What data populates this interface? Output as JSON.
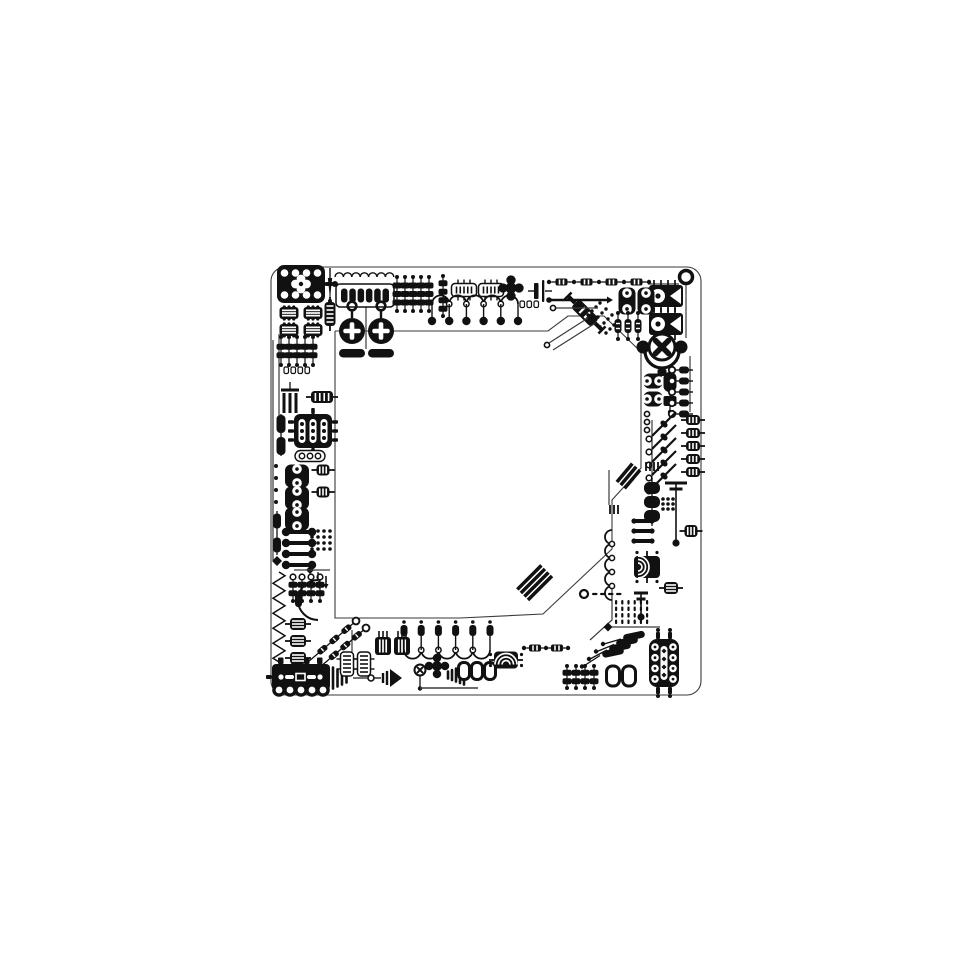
{
  "canvas": {
    "width": 960,
    "height": 960,
    "background": "#ffffff",
    "ink": "#111111",
    "trace_color": "#3a3a3a",
    "white": "#ffffff"
  },
  "traces": [
    {
      "t": "orect",
      "n": "outer-outline",
      "x": 271,
      "y": 267,
      "w": 430,
      "h": 428,
      "r": 14
    },
    {
      "t": "trace",
      "n": "inner-outline",
      "pts": [
        [
          335,
          331
        ],
        [
          548,
          331
        ],
        [
          568,
          316
        ],
        [
          604,
          316
        ],
        [
          641,
          352
        ],
        [
          641,
          468
        ],
        [
          612,
          500
        ],
        [
          612,
          549
        ],
        [
          543,
          614
        ],
        [
          460,
          618
        ],
        [
          335,
          618
        ],
        [
          335,
          331
        ]
      ],
      "sw": 1.1
    },
    {
      "t": "trace",
      "n": "trace-1",
      "pts": [
        [
          330,
          268
        ],
        [
          330,
          300
        ]
      ],
      "sw": 1.2
    },
    {
      "t": "trace",
      "n": "trace-2",
      "pts": [
        [
          366,
          284
        ],
        [
          366,
          349
        ]
      ],
      "sw": 1.2
    },
    {
      "t": "trace",
      "n": "trace-3",
      "pts": [
        [
          648,
          284
        ],
        [
          679,
          284
        ]
      ],
      "sw": 1.2
    },
    {
      "t": "trace",
      "n": "trace-4",
      "pts": [
        [
          686,
          284
        ],
        [
          686,
          338
        ]
      ],
      "sw": 1.2
    },
    {
      "t": "trace",
      "n": "trace-5",
      "pts": [
        [
          690,
          356
        ],
        [
          690,
          412
        ]
      ],
      "sw": 1.2
    },
    {
      "t": "trace",
      "n": "trace-6",
      "pts": [
        [
          652,
          420
        ],
        [
          652,
          488
        ]
      ],
      "sw": 1.2
    },
    {
      "t": "trace",
      "n": "trace-7",
      "pts": [
        [
          609,
          470
        ],
        [
          609,
          505
        ]
      ],
      "sw": 1.2
    },
    {
      "t": "trace",
      "n": "trace-8",
      "pts": [
        [
          279,
          334
        ],
        [
          279,
          420
        ]
      ],
      "sw": 1.2
    },
    {
      "t": "trace",
      "n": "trace-9",
      "pts": [
        [
          273,
          340
        ],
        [
          273,
          560
        ]
      ],
      "sw": 1.2
    },
    {
      "t": "trace",
      "n": "trace-10",
      "pts": [
        [
          612,
          584
        ],
        [
          612,
          620
        ],
        [
          590,
          640
        ]
      ],
      "sw": 1.2
    },
    {
      "t": "trace",
      "n": "trace-11",
      "pts": [
        [
          352,
          630
        ],
        [
          352,
          652
        ]
      ],
      "sw": 1.2
    }
  ],
  "components": [
    {
      "t": "icPads",
      "n": "ic-chip-top-left",
      "cx": 301,
      "cy": 284,
      "w": 48,
      "h": 38
    },
    {
      "t": "dipStriped",
      "n": "striped-cap-grid",
      "at": [
        [
          289,
          313
        ],
        [
          313,
          313
        ],
        [
          289,
          330
        ],
        [
          313,
          330
        ]
      ],
      "w": 19,
      "h": 12,
      "o": "h"
    },
    {
      "t": "needle",
      "n": "pin-needle",
      "x": 330,
      "y": 268,
      "len": 30
    },
    {
      "t": "ribbedCap",
      "n": "coil-inductor",
      "cx": 330,
      "cy": 314,
      "w": 11,
      "h": 24,
      "o": "h",
      "ribs": 5
    },
    {
      "t": "scallop",
      "n": "scallop-trace",
      "x": 335,
      "y": 277,
      "num": 7,
      "r": 4.2
    },
    {
      "t": "capRow",
      "n": "pad-array-top",
      "x": 336,
      "y": 284,
      "w": 58,
      "h": 23,
      "slots": 6
    },
    {
      "t": "keyhole",
      "n": "keyhole-pad-left",
      "cx": 352,
      "ty": 302
    },
    {
      "t": "keyhole",
      "n": "keyhole-pad-right",
      "cx": 381,
      "ty": 302
    },
    {
      "t": "beadCol",
      "n": "bead-columns-top",
      "at": [
        [
          397,
          294
        ],
        [
          405,
          294
        ],
        [
          413,
          294
        ],
        [
          421,
          294
        ],
        [
          429,
          294
        ]
      ],
      "beads": 3,
      "h": 34
    },
    {
      "t": "beadCol",
      "n": "bead-strip",
      "cx": 443,
      "cy": 296,
      "beads": 4,
      "h": 40
    },
    {
      "t": "dipOutline",
      "n": "striped-ic-a",
      "cx": 464,
      "cy": 290,
      "w": 25,
      "h": 13,
      "o": "h"
    },
    {
      "t": "dipOutline",
      "n": "striped-ic-b",
      "cx": 491,
      "cy": 290,
      "w": 25,
      "h": 13,
      "o": "h"
    },
    {
      "t": "flower5",
      "n": "dot-cluster-top",
      "cx": 511,
      "cy": 288,
      "r": 5.5,
      "d": 8
    },
    {
      "t": "waveTrace",
      "n": "wave-trace-top",
      "x": 432,
      "y": 304,
      "num": 5,
      "r": 8.6,
      "dir": "up",
      "pins": "down",
      "pad": "circle"
    },
    {
      "t": "microPads",
      "n": "micro-pads-top",
      "x": 520,
      "y": 301,
      "num": 3
    },
    {
      "t": "capBars",
      "n": "capacitor-symbol",
      "cx": 541,
      "cy": 291
    },
    {
      "t": "thickLink",
      "n": "bus-link",
      "x1": 549,
      "y1": 300,
      "x2": 607,
      "y2": 300
    },
    {
      "t": "resistorChainH",
      "n": "resistor-chain-top",
      "x": 549,
      "y": 282,
      "num": 4,
      "pitch": 25
    },
    {
      "t": "ringPad",
      "n": "corner-via",
      "cx": 686,
      "cy": 277,
      "r": 6.5,
      "sw": 3.5
    },
    {
      "t": "speakerIC",
      "n": "opto-ic-a",
      "cx": 666,
      "cy": 296,
      "w": 34,
      "h": 22
    },
    {
      "t": "speakerIC",
      "n": "opto-ic-b",
      "cx": 666,
      "cy": 324,
      "w": 34,
      "h": 22
    },
    {
      "t": "diagResistor",
      "n": "diagonal-resistor",
      "cx": 585,
      "cy": 313,
      "a": 45
    },
    {
      "t": "diagDots",
      "n": "diagonal-dots",
      "x": 600,
      "y": 303,
      "rows": 4,
      "cols": 4
    },
    {
      "t": "ring8",
      "n": "double-ring-a",
      "cx": 627,
      "cy": 301,
      "w": 17,
      "h": 27,
      "o": "v"
    },
    {
      "t": "ring8",
      "n": "double-ring-b",
      "cx": 646,
      "cy": 301,
      "w": 17,
      "h": 27,
      "o": "v"
    },
    {
      "t": "beadCol",
      "n": "resistor-triple",
      "at": [
        [
          618,
          326
        ],
        [
          628,
          326
        ],
        [
          638,
          326
        ]
      ],
      "beads": 1,
      "h": 26
    },
    {
      "t": "xFan",
      "n": "fan-component",
      "cx": 662,
      "cy": 347,
      "r": 13
    },
    {
      "t": "ringPad",
      "n": "via-a",
      "cx": 547,
      "cy": 345,
      "r": 2.6,
      "sw": 1.6
    },
    {
      "t": "trace",
      "n": "diag-trace-a",
      "pts": [
        [
          549,
          343
        ],
        [
          588,
          318
        ]
      ],
      "sw": 1.2
    },
    {
      "t": "trace",
      "n": "diag-trace-b",
      "pts": [
        [
          553,
          350
        ],
        [
          594,
          324
        ]
      ],
      "sw": 1.2
    },
    {
      "t": "trace",
      "n": "h-trace-a",
      "pts": [
        [
          556,
          308
        ],
        [
          598,
          308
        ]
      ],
      "sw": 1.2
    },
    {
      "t": "ringPad",
      "n": "via-b",
      "cx": 553,
      "cy": 308,
      "r": 2.6,
      "sw": 1.6
    },
    {
      "t": "ring8",
      "n": "double-ring-right",
      "at": [
        [
          653,
          381
        ],
        [
          653,
          399
        ]
      ],
      "w": 19,
      "h": 15,
      "o": "h"
    },
    {
      "t": "capSq",
      "n": "cap-and-square",
      "cx": 670,
      "cy": 382
    },
    {
      "t": "diodeCol",
      "n": "diode-column",
      "x": 672,
      "y": 370,
      "num": 5,
      "st": 11
    },
    {
      "t": "ribbedCap",
      "n": "ribbed-caps-right",
      "at": [
        [
          693,
          420
        ],
        [
          693,
          433
        ],
        [
          693,
          446
        ],
        [
          693,
          459
        ],
        [
          693,
          472
        ]
      ],
      "w": 14,
      "h": 10,
      "o": "v",
      "ribs": 3
    },
    {
      "t": "dotCol",
      "n": "via-column",
      "cx": 647,
      "ys": [
        414,
        422,
        430
      ],
      "r": 2.6,
      "ring": true
    },
    {
      "t": "diagLadder",
      "n": "diagonal-ladder",
      "x": 652,
      "y": 436,
      "num": 5,
      "st": 13
    },
    {
      "t": "pinComb",
      "n": "pin-comb-right",
      "x": 646,
      "y": 462,
      "num": 4
    },
    {
      "t": "diagStripes",
      "n": "cable-stripes-a",
      "x": 640,
      "y": 470,
      "num": 3,
      "len": 24,
      "a": 130
    },
    {
      "t": "capsuleChainV",
      "n": "capsule-chain-right",
      "cx": 652,
      "ys": [
        488,
        502,
        516
      ],
      "w": 16,
      "h": 12
    },
    {
      "t": "antennaT",
      "n": "antenna-cap",
      "x": 676,
      "y1": 482,
      "y2": 540,
      "w1": 22,
      "w2": 13
    },
    {
      "t": "dotGrid",
      "n": "dot-grid-right",
      "cx": 668,
      "cy": 504,
      "rows": 3,
      "cols": 3,
      "p": 5
    },
    {
      "t": "ribbedCap",
      "n": "slot-component",
      "cx": 691,
      "cy": 531,
      "w": 13,
      "h": 12,
      "o": "v",
      "ribs": 3
    },
    {
      "t": "dumbbellRow",
      "n": "pin-pair-rows",
      "at": [
        [
          643,
          521
        ],
        [
          643,
          531
        ],
        [
          643,
          541
        ]
      ],
      "w": 18,
      "r": 2.6
    },
    {
      "t": "arcRadiator",
      "n": "arc-component-right",
      "cx": 647,
      "cy": 567,
      "w": 22,
      "h": 26,
      "rot": 90
    },
    {
      "t": "ringWaveV",
      "n": "ring-wave-right",
      "x": 612,
      "y": 530,
      "num": 5,
      "r": 7
    },
    {
      "t": "pinComb",
      "n": "pin-comb-mid",
      "x": 610,
      "y": 505,
      "num": 3
    },
    {
      "t": "ribbedCap",
      "n": "ribbed-small-right",
      "cx": 671,
      "cy": 588,
      "w": 14,
      "h": 12,
      "o": "h",
      "ribs": 3
    },
    {
      "t": "antennaT",
      "n": "cap-t-small",
      "x": 641,
      "y1": 592,
      "y2": 614,
      "w1": 14,
      "w2": 9
    },
    {
      "t": "ringPad",
      "n": "via-c",
      "cx": 584,
      "cy": 594,
      "r": 4,
      "sw": 2.2
    },
    {
      "t": "dashRow",
      "n": "dash-row",
      "x": 592,
      "y": 594,
      "num": 4
    },
    {
      "t": "vDashGrid",
      "n": "dash-grid",
      "x": 615,
      "y": 600,
      "cols": 6,
      "rows": 4
    },
    {
      "t": "diamond",
      "n": "diamond-pin",
      "cx": 608,
      "cy": 627,
      "r": 4.5
    },
    {
      "t": "trace",
      "n": "h-trace-b",
      "pts": [
        [
          612,
          627
        ],
        [
          660,
          627
        ]
      ],
      "sw": 1.3
    },
    {
      "t": "fanResistors",
      "n": "fan-resistors",
      "bx": 634,
      "by": 636
    },
    {
      "t": "dipRoundPins",
      "n": "ic-bottom-right",
      "cx": 664,
      "cy": 663,
      "w": 30,
      "h": 48
    },
    {
      "t": "beadCol",
      "n": "dot-dash-cols",
      "at": [
        [
          567,
          677
        ],
        [
          576,
          677
        ],
        [
          585,
          677
        ],
        [
          594,
          677
        ]
      ],
      "beads": 2,
      "h": 22
    },
    {
      "t": "ringRects",
      "n": "ring-rects-pair",
      "cx": 621,
      "cy": 676,
      "num": 2,
      "w": 13,
      "h": 20,
      "pitch": 16
    },
    {
      "t": "diagStripes",
      "n": "cable-stripes-b",
      "x": 552,
      "y": 576,
      "num": 4,
      "len": 34,
      "a": 135
    },
    {
      "t": "connectorBlock",
      "n": "edge-connector",
      "cx": 301,
      "cy": 677,
      "w": 58,
      "h": 26
    },
    {
      "t": "jackBars",
      "n": "jack-bars",
      "x": 333,
      "cy": 678,
      "num": 4,
      "tail": true
    },
    {
      "t": "ribbedCap",
      "n": "ribbed-caps-left-col",
      "at": [
        [
          298,
          624
        ],
        [
          298,
          641
        ],
        [
          298,
          658
        ]
      ],
      "w": 16,
      "h": 12,
      "o": "h",
      "ribs": 3
    },
    {
      "t": "zigzagV",
      "n": "spring-coil",
      "x": 279,
      "y1": 572,
      "y2": 660,
      "per": 15,
      "amp": 6
    },
    {
      "t": "diagChain",
      "n": "diag-chain-a",
      "x1": 308,
      "y1": 662,
      "x2": 356,
      "y2": 621
    },
    {
      "t": "diagChain",
      "n": "diag-chain-b",
      "x1": 320,
      "y1": 667,
      "x2": 366,
      "y2": 628
    },
    {
      "t": "dipOutline",
      "n": "dip-v-pair",
      "at": [
        [
          347,
          664
        ],
        [
          364,
          664
        ]
      ],
      "w": 13,
      "h": 24,
      "o": "v"
    },
    {
      "t": "dipStriped",
      "n": "striped-caps-bottom",
      "at": [
        [
          383,
          646
        ],
        [
          402,
          646
        ]
      ],
      "w": 16,
      "h": 18,
      "o": "v",
      "comb": true
    },
    {
      "t": "waveTrace",
      "n": "wave-trace-bottom",
      "x": 404,
      "y": 650,
      "num": 5,
      "r": 8.6,
      "dir": "down",
      "pins": "up",
      "pad": "capsule"
    },
    {
      "t": "coneJack",
      "n": "cone-speaker",
      "x": 371,
      "cy": 678
    },
    {
      "t": "xRing",
      "n": "x-via",
      "cx": 420,
      "cy": 670,
      "r": 5.5
    },
    {
      "t": "flower5",
      "n": "dot-cluster-bottom",
      "cx": 437,
      "cy": 666,
      "r": 5,
      "d": 8
    },
    {
      "t": "jackBars",
      "n": "rising-bars",
      "x": 448,
      "cy": 675,
      "num": 5,
      "asc": true
    },
    {
      "t": "ringRects",
      "n": "ring-rects-triple",
      "cx": 477,
      "cy": 671,
      "num": 3,
      "w": 11,
      "h": 17,
      "pitch": 13
    },
    {
      "t": "arcRadiator",
      "n": "arc-component-bottom",
      "cx": 506,
      "cy": 660,
      "w": 24,
      "h": 17,
      "rot": 0
    },
    {
      "t": "resistorChainH",
      "n": "resistor-chain-bottom",
      "x": 524,
      "y": 648,
      "num": 2,
      "pitch": 22
    },
    {
      "t": "trace",
      "n": "h-trace-c",
      "pts": [
        [
          420,
          688
        ],
        [
          478,
          688
        ]
      ],
      "sw": 1.4
    },
    {
      "t": "beadCol",
      "n": "bead-rows-left",
      "at": [
        [
          281,
          351
        ],
        [
          289,
          351
        ],
        [
          297,
          351
        ],
        [
          305,
          351
        ],
        [
          313,
          351
        ]
      ],
      "beads": 2,
      "h": 28
    },
    {
      "t": "microPads",
      "n": "micro-pads-left",
      "x": 284,
      "y": 367,
      "num": 4
    },
    {
      "t": "capsule3V",
      "n": "triple-bars",
      "cx": 290,
      "cy": 402
    },
    {
      "t": "ribbedCap",
      "n": "ribbed-left-top",
      "cx": 322,
      "cy": 397,
      "w": 22,
      "h": 12,
      "o": "v",
      "ribs": 4
    },
    {
      "t": "capsuleChainV",
      "n": "capsules-left",
      "cx": 281,
      "ys": [
        424,
        446
      ],
      "w": 9,
      "h": 18
    },
    {
      "t": "icRoundSlots",
      "n": "ic-left",
      "cx": 313,
      "cy": 431,
      "w": 38,
      "h": 34
    },
    {
      "t": "ringsRow",
      "n": "triple-ring-left",
      "cx": 310,
      "cy": 456,
      "w": 30,
      "h": 11,
      "num": 3
    },
    {
      "t": "ring8",
      "n": "double-ring-left-col",
      "at": [
        [
          297,
          476
        ],
        [
          297,
          498
        ],
        [
          297,
          519
        ]
      ],
      "w": 24,
      "h": 23,
      "o": "v"
    },
    {
      "t": "ribbedCap",
      "n": "ribbed-left-mid",
      "at": [
        [
          323,
          470
        ],
        [
          323,
          492
        ]
      ],
      "w": 13,
      "h": 11,
      "o": "v",
      "ribs": 3
    },
    {
      "t": "dotCol",
      "n": "dots-left",
      "cx": 276,
      "ys": [
        466,
        478,
        490,
        502
      ],
      "r": 2
    },
    {
      "t": "dumbbellRow",
      "n": "dumbbell-rows",
      "at": [
        [
          299,
          532
        ],
        [
          299,
          543
        ],
        [
          299,
          554
        ],
        [
          299,
          565
        ]
      ],
      "w": 26,
      "r": 4.2
    },
    {
      "t": "dotGrid",
      "n": "dot-grid-left",
      "cx": 321,
      "cy": 540,
      "rows": 4,
      "cols": 4,
      "p": 6
    },
    {
      "t": "capsuleChainV",
      "n": "left-edge-caps",
      "cx": 277,
      "ys": [
        521,
        545
      ],
      "w": 8,
      "h": 15
    },
    {
      "t": "diamond",
      "n": "diamond-left",
      "cx": 277,
      "cy": 561,
      "r": 5
    },
    {
      "t": "diamond",
      "n": "diamond-mid",
      "cx": 310,
      "cy": 570,
      "r": 4
    },
    {
      "t": "trace",
      "n": "h-trace-d",
      "pts": [
        [
          294,
          570
        ],
        [
          330,
          570
        ]
      ],
      "sw": 1.2
    },
    {
      "t": "arrowPins",
      "n": "arrow-pins",
      "x": 312,
      "y": 576,
      "num": 3,
      "pitch": 7
    },
    {
      "t": "beadCol",
      "n": "bead-cols-lower-left",
      "at": [
        [
          293,
          589
        ],
        [
          302,
          589
        ],
        [
          311,
          589
        ],
        [
          320,
          589
        ]
      ],
      "beads": 2,
      "h": 24,
      "ringTop": true
    },
    {
      "t": "quarterArc",
      "n": "arc-left",
      "cx": 322,
      "cy": 600,
      "r": 20
    }
  ]
}
